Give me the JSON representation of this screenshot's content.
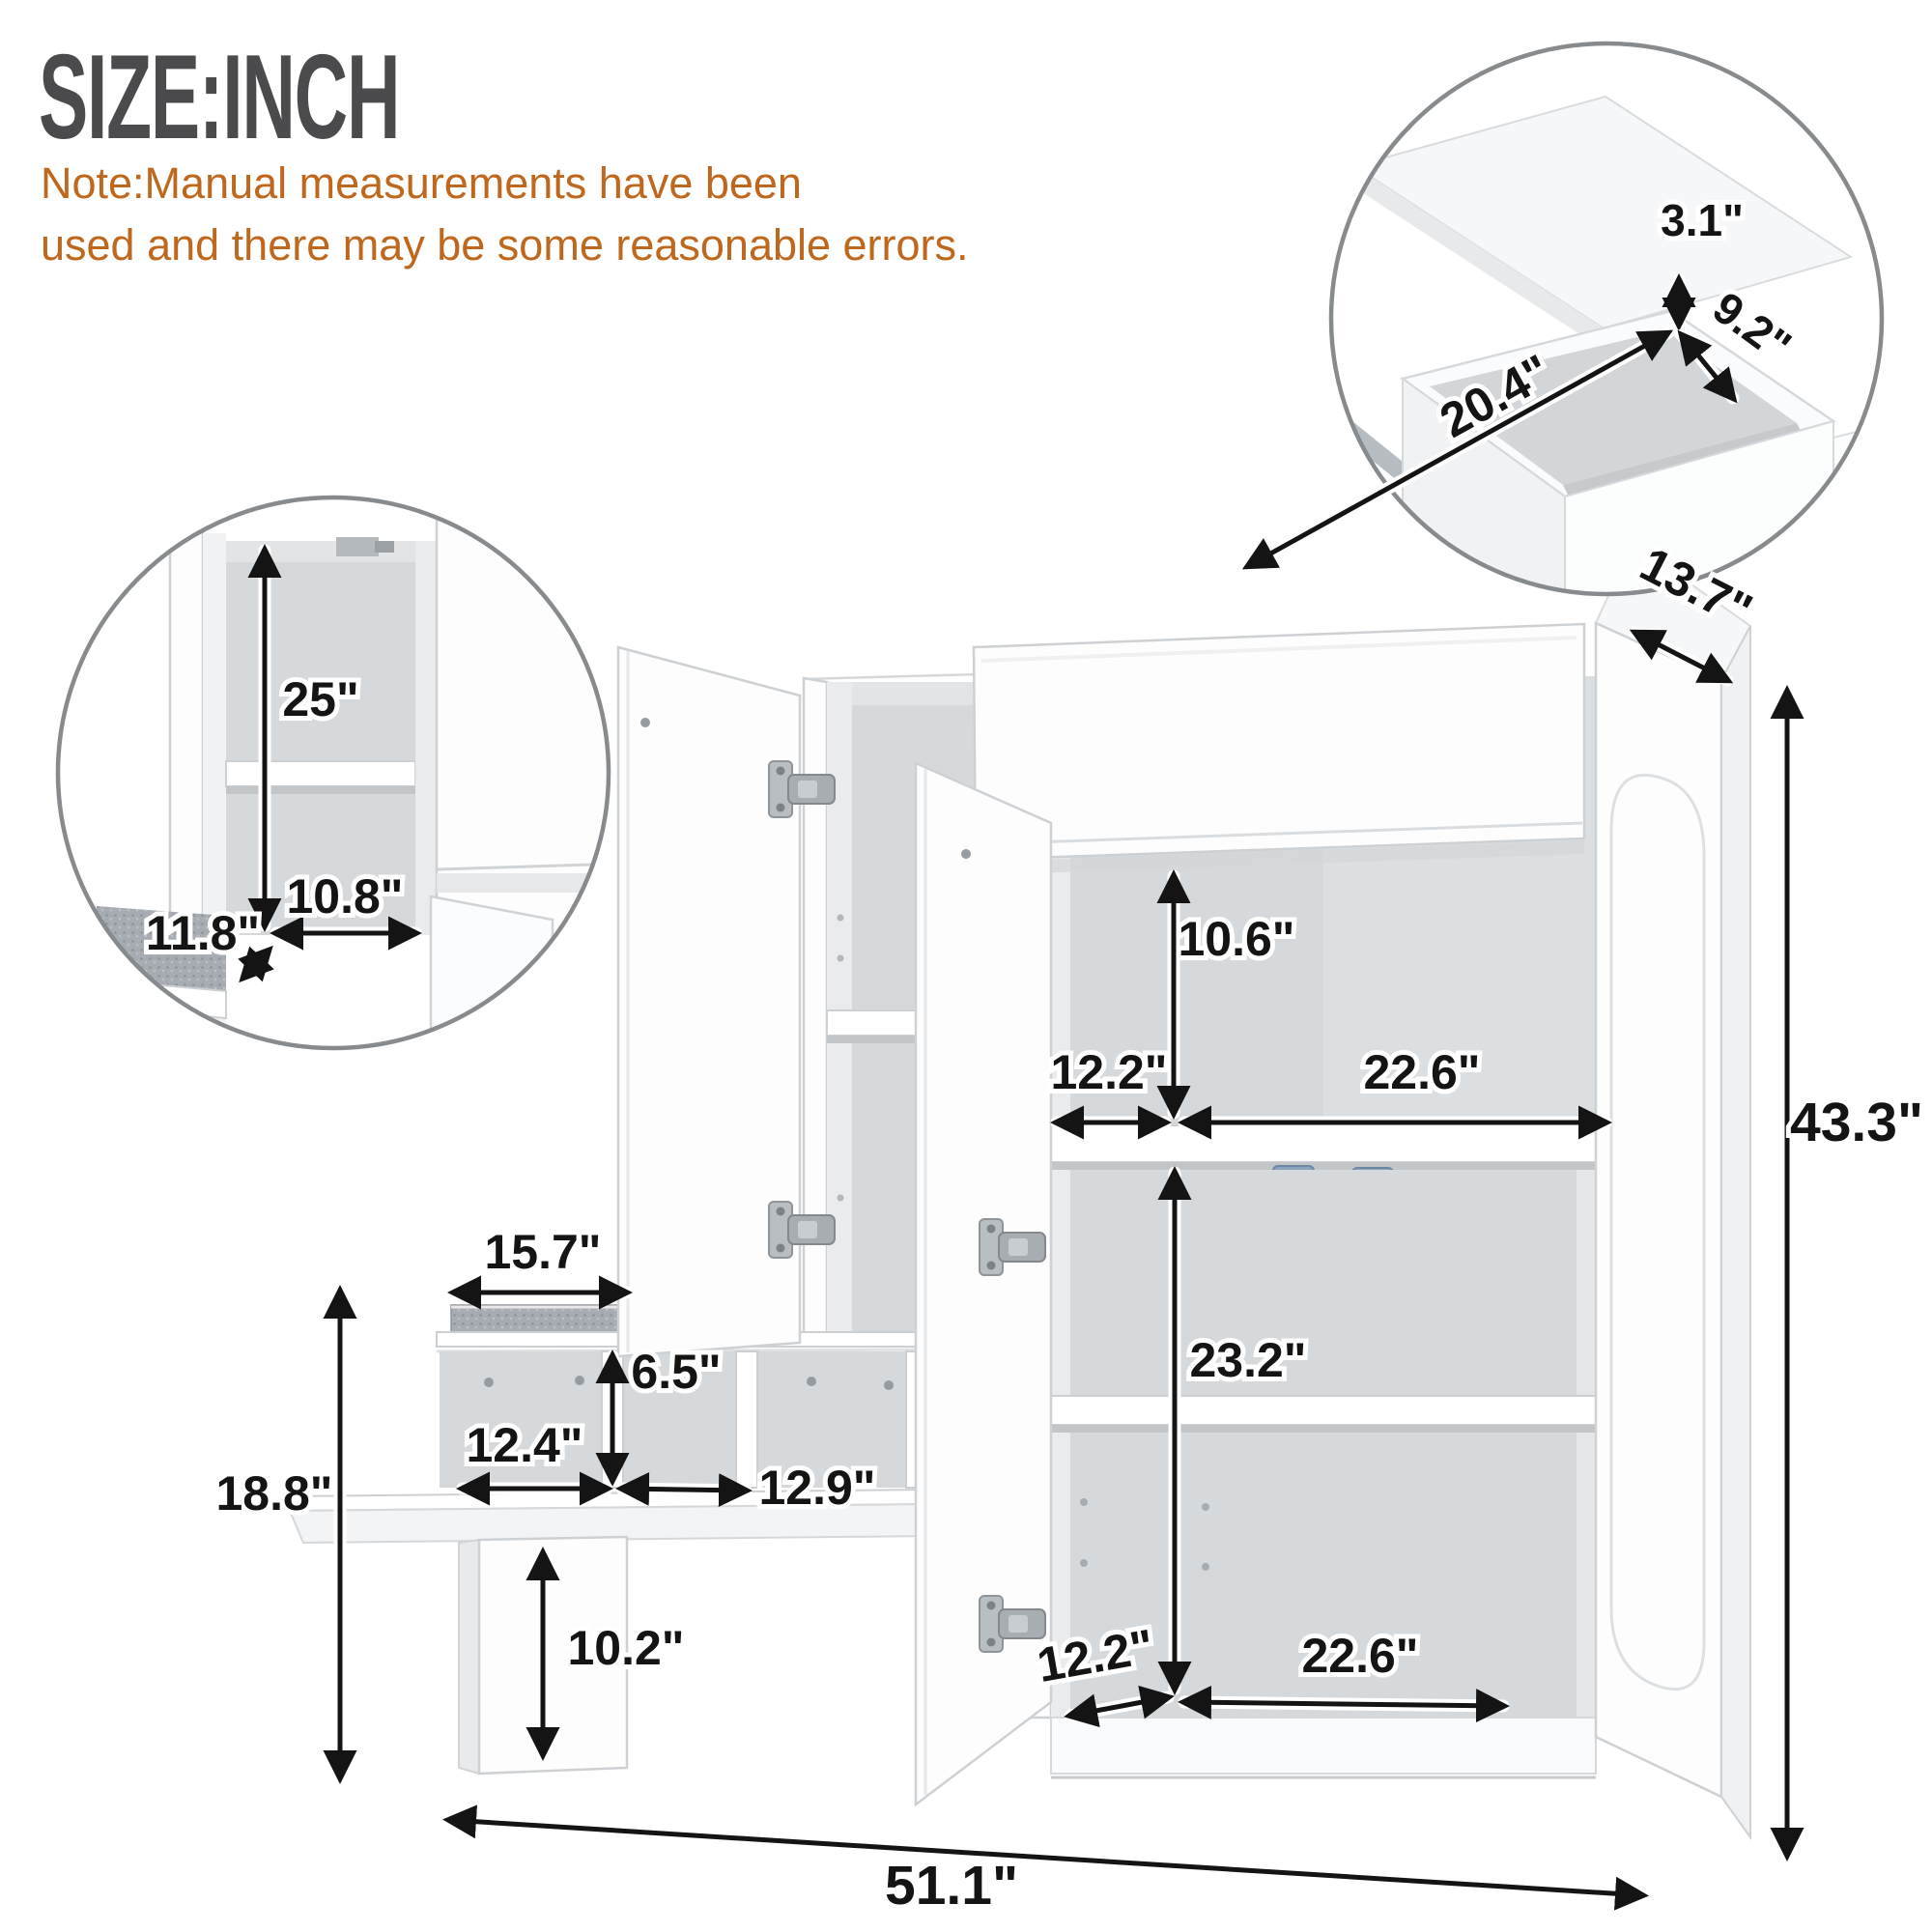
{
  "title": "SIZE:INCH",
  "note": {
    "line1": "Note:Manual measurements have been",
    "line2": "used and there may be some reasonable errors."
  },
  "dims": {
    "depth": "13.7\"",
    "height": "43.3\"",
    "width": "51.1\"",
    "upper_opening": "10.6\"",
    "upper_left": "12.2\"",
    "upper_right": "22.6\"",
    "lower_opening": "23.2\"",
    "lower_left": "12.2\"",
    "lower_right": "22.6\"",
    "seat": "15.7\"",
    "cubby_height": "6.5\"",
    "cubby_left": "12.4\"",
    "cubby_right": "12.9\"",
    "bench_height": "18.8\"",
    "leg": "10.2\""
  },
  "inset_drawer": {
    "gap": "3.1\"",
    "depth": "9.2\"",
    "width": "20.4\""
  },
  "inset_cabinet": {
    "height": "25\"",
    "width": "10.8\"",
    "depth": "11.8\""
  },
  "colors": {
    "title": "#4b4b4d",
    "note": "#bf671d",
    "dimension": "#141414",
    "circle_border": "#878b8e",
    "cushion": "#a6acb2",
    "clip_blue": "#8aa3bf"
  }
}
